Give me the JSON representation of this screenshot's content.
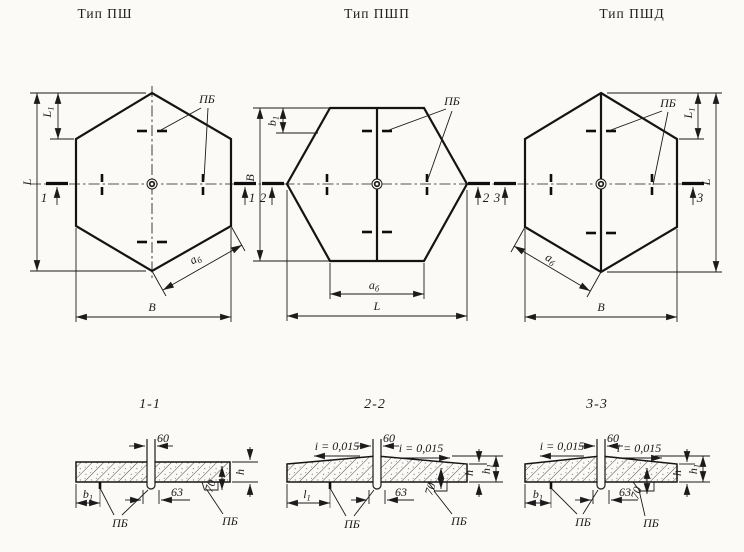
{
  "titles": {
    "psh": "Тип ПШ",
    "pshp": "Тип ПШП",
    "pshd": "Тип ПШД"
  },
  "plan": {
    "pb": "ПБ",
    "L": "L",
    "B": "В",
    "L1_base": "L",
    "L1_sub": "1",
    "b1_base": "b",
    "b1_sub": "1",
    "ab_base": "а",
    "ab_sub": "б",
    "cut1": "1",
    "cut2": "2",
    "cut3": "3"
  },
  "sections": {
    "s1_title": "1-1",
    "s2_title": "2-2",
    "s3_title": "3-3",
    "dim60": "60",
    "dim63": "63",
    "dim70": "70",
    "slope": "i = 0,015",
    "h": "h",
    "h1_base": "h",
    "h1_sub": "1",
    "l1_base": "l",
    "l1_sub": "1",
    "b1_base": "b",
    "b1_sub": "1",
    "pb": "ПБ"
  },
  "colors": {
    "ink": "#1b1b1b",
    "paper": "#fbfaf7"
  }
}
